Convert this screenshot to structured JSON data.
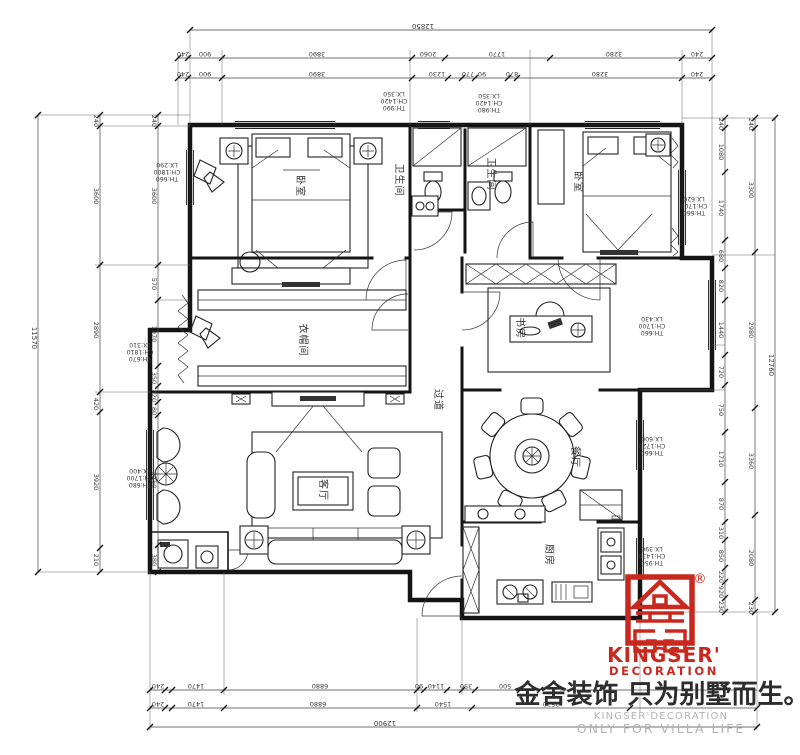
{
  "accent": "#c9281f",
  "rooms": {
    "master_bedroom": "卧室",
    "bedroom2": "卧室",
    "bath1": "卫生间",
    "bath2": "卫生间",
    "cloakroom": "衣帽间",
    "corridor": "过道",
    "study": "书房",
    "living": "客厅",
    "dining": "餐厅",
    "kitchen": "厨房"
  },
  "tags": [
    {
      "th": "TH:990",
      "ch": "CH:1420",
      "lx": "LX:350"
    },
    {
      "th": "TH:980",
      "ch": "CH:1420",
      "lx": "LX:350"
    },
    {
      "th": "TH:660",
      "ch": "CH:1800",
      "lx": "LX:290"
    },
    {
      "th": "TH:670",
      "ch": "CH:1810",
      "lx": "LX:310"
    },
    {
      "th": "TH:680",
      "ch": "CH:1700",
      "lx": "LX:400"
    },
    {
      "th": "TH:660",
      "ch": "CH:1700",
      "lx": "LX:620"
    },
    {
      "th": "TH:660",
      "ch": "CH:1700",
      "lx": "LX:430"
    },
    {
      "th": "TH:660",
      "ch": "CH:1720",
      "lx": "LX:600"
    },
    {
      "th": "TH:950",
      "ch": "CH:1430",
      "lx": "LX:390"
    }
  ],
  "dims": {
    "top": {
      "overall": "12850",
      "row1": [
        "240",
        "900",
        "3890",
        "2060",
        "1770",
        "3280",
        "240"
      ],
      "row2": [
        "240",
        "900",
        "3890",
        "1230",
        "770",
        "90",
        "870",
        "3280",
        "240"
      ]
    },
    "bottom": {
      "overall": "12900",
      "row1": [
        "240",
        "1470",
        "6880",
        "90",
        "1140",
        "350",
        "500"
      ],
      "row2": [
        "240",
        "1470",
        "6880",
        "1540",
        "2520"
      ]
    },
    "left": {
      "overall": "11570",
      "outer": [
        "240",
        "3600",
        "2890",
        "420",
        "3920",
        "210"
      ],
      "inner": [
        "240",
        "3600",
        "570",
        "1970",
        "350",
        "420",
        "80",
        "3250",
        "380"
      ]
    },
    "right": {
      "overall": "12760",
      "outer": [
        "240",
        "3300",
        "2980",
        "3360",
        "2080",
        "230"
      ],
      "inner": [
        "240",
        "1080",
        "1740",
        "680",
        "820",
        "1440",
        "720",
        "750",
        "1710",
        "870",
        "310",
        "850",
        "220",
        "920",
        "230"
      ]
    }
  },
  "logo": {
    "registered": "®",
    "brand": "KINGSER'",
    "brand_sub": "DECORATION",
    "slogan_cn": "金舍装饰 只为别墅而生。",
    "tagline1": "KINGSER'DECORATION",
    "tagline2": "ONLY FOR VILLA LIFE"
  }
}
